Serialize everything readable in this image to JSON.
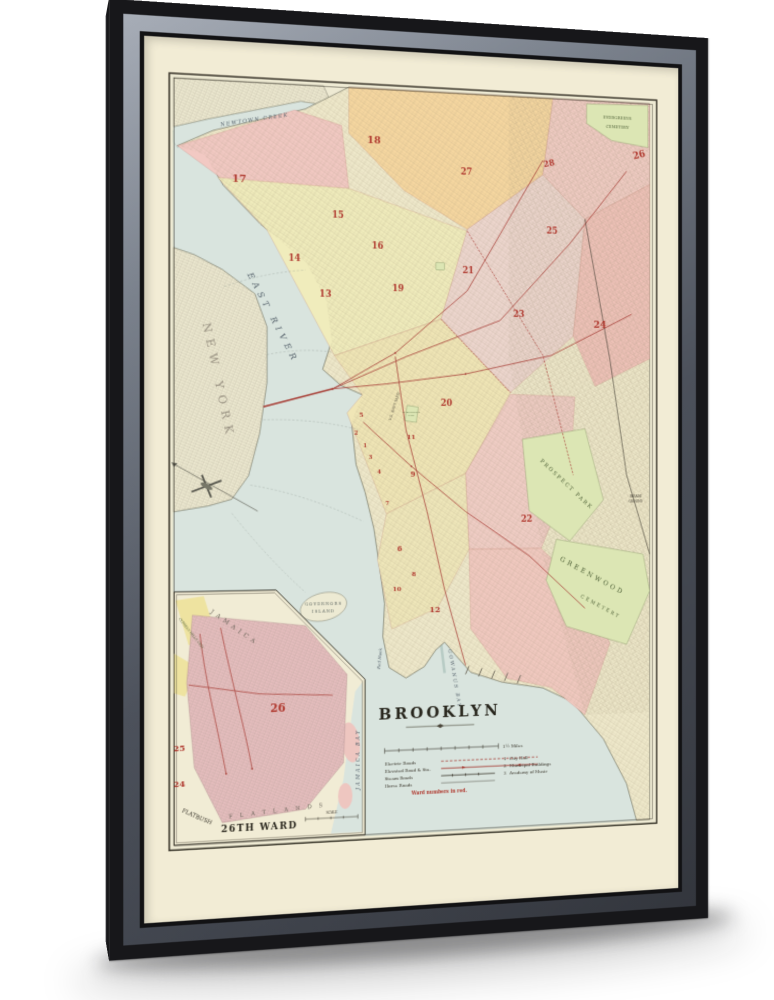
{
  "map": {
    "title": "BROOKLYN",
    "scale_note": "1¼ Miles",
    "legend": {
      "electric": "Electric Roads",
      "elevated": "Elevated Road & Sta.",
      "steam": "Steam Roads",
      "horse": "Horse Roads",
      "note": "Ward numbers in red.",
      "key1_num": "1",
      "key1": "City Hall",
      "key2_num": "2",
      "key2": "Municipal Buildings",
      "key3_num": "3",
      "key3": "Academy of Music"
    },
    "places": {
      "evergreens1": "EVERGREENS",
      "evergreens2": "CEMETERY",
      "newtown_creek": "NEWTOWN CREEK",
      "east_river": "EAST RIVER",
      "new_york": "NEW YORK",
      "navy_yard": "U.S. NAVY YARD",
      "washington_park1": "WASHINGTON",
      "washington_park2": "PARK",
      "governors1": "GOVERNORS",
      "governors2": "ISLAND",
      "red_hook": "Red Hook",
      "gowanus_bay": "GOWANUS BAY",
      "prospect_park": "PROSPECT PARK",
      "parade1": "PARADE",
      "parade2": "GROUND",
      "greenwood1": "GREENWOOD",
      "greenwood2": "CEMETERY"
    },
    "wards": {
      "w1": "1",
      "w2": "2",
      "w3": "3",
      "w4": "4",
      "w5": "5",
      "w6": "6",
      "w7": "7",
      "w8": "8",
      "w9": "9",
      "w10": "10",
      "w11": "11",
      "w12": "12",
      "w13": "13",
      "w14": "14",
      "w15": "15",
      "w16": "16",
      "w17": "17",
      "w18": "18",
      "w19": "19",
      "w20": "20",
      "w21": "21",
      "w22": "22",
      "w23": "23",
      "w24": "24",
      "w25": "25",
      "w26": "26",
      "w27": "27",
      "w28": "28"
    },
    "inset": {
      "title": "26TH WARD",
      "w26": "26",
      "w25": "25",
      "w24": "24",
      "jamaica": "JAMAICA",
      "jamaica_bay": "JAMAICA BAY",
      "flatlands": "FLATLANDS",
      "flatbush": "FLATBUSH",
      "cypress": "CYPRESS HILLS CEM.",
      "scale": "SCALE"
    }
  },
  "colors": {
    "frame": "#17171a",
    "canvas": "#f2ecd5",
    "paper": "#eeead3",
    "water": "#d9e4de",
    "ward_red": "#b0392f",
    "rail_red": "#a84038",
    "pink": "#f2c9c3",
    "orange": "#f6d7a0",
    "yellow": "#f0ecbc",
    "green": "#dce6b4"
  }
}
